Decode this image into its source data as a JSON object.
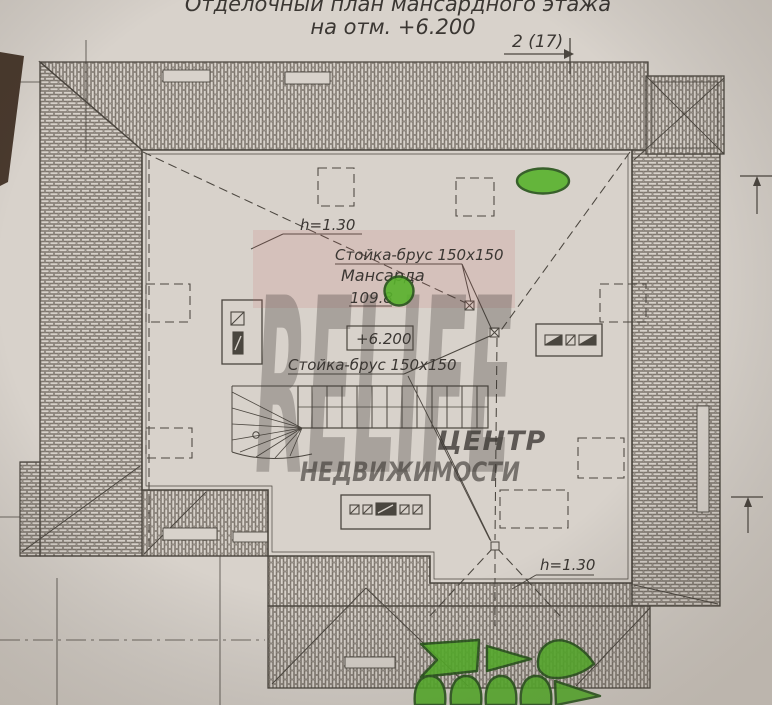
{
  "document": {
    "title_line1": "Отделочный план мансардного этажа",
    "title_line2": "на отм. +6.200",
    "section_marker": "2 (17)"
  },
  "plan": {
    "room": {
      "name": "Мансарда",
      "area": "109.8",
      "elevation": "+6.200"
    },
    "annotations": {
      "post_label_top": "Стойка-брус 150x150",
      "post_label_bottom": "Стойка-брус 150x150",
      "roof_height_top": "h=1.30",
      "roof_height_bottom": "h=1.30"
    }
  },
  "watermark": {
    "brand": "RELIFE",
    "line1": "ЦЕНТР",
    "line2": "НЕДВИЖИМОСТИ"
  },
  "colors": {
    "paper": "#d8d2cb",
    "ink": "#4b463f",
    "hatch": "#6e675e",
    "green_marker": "#58b22c",
    "green_edge": "#27541a",
    "watermark_pink": "#c35f5d",
    "watermark_red": "#b93734",
    "desk": "#47392f"
  }
}
